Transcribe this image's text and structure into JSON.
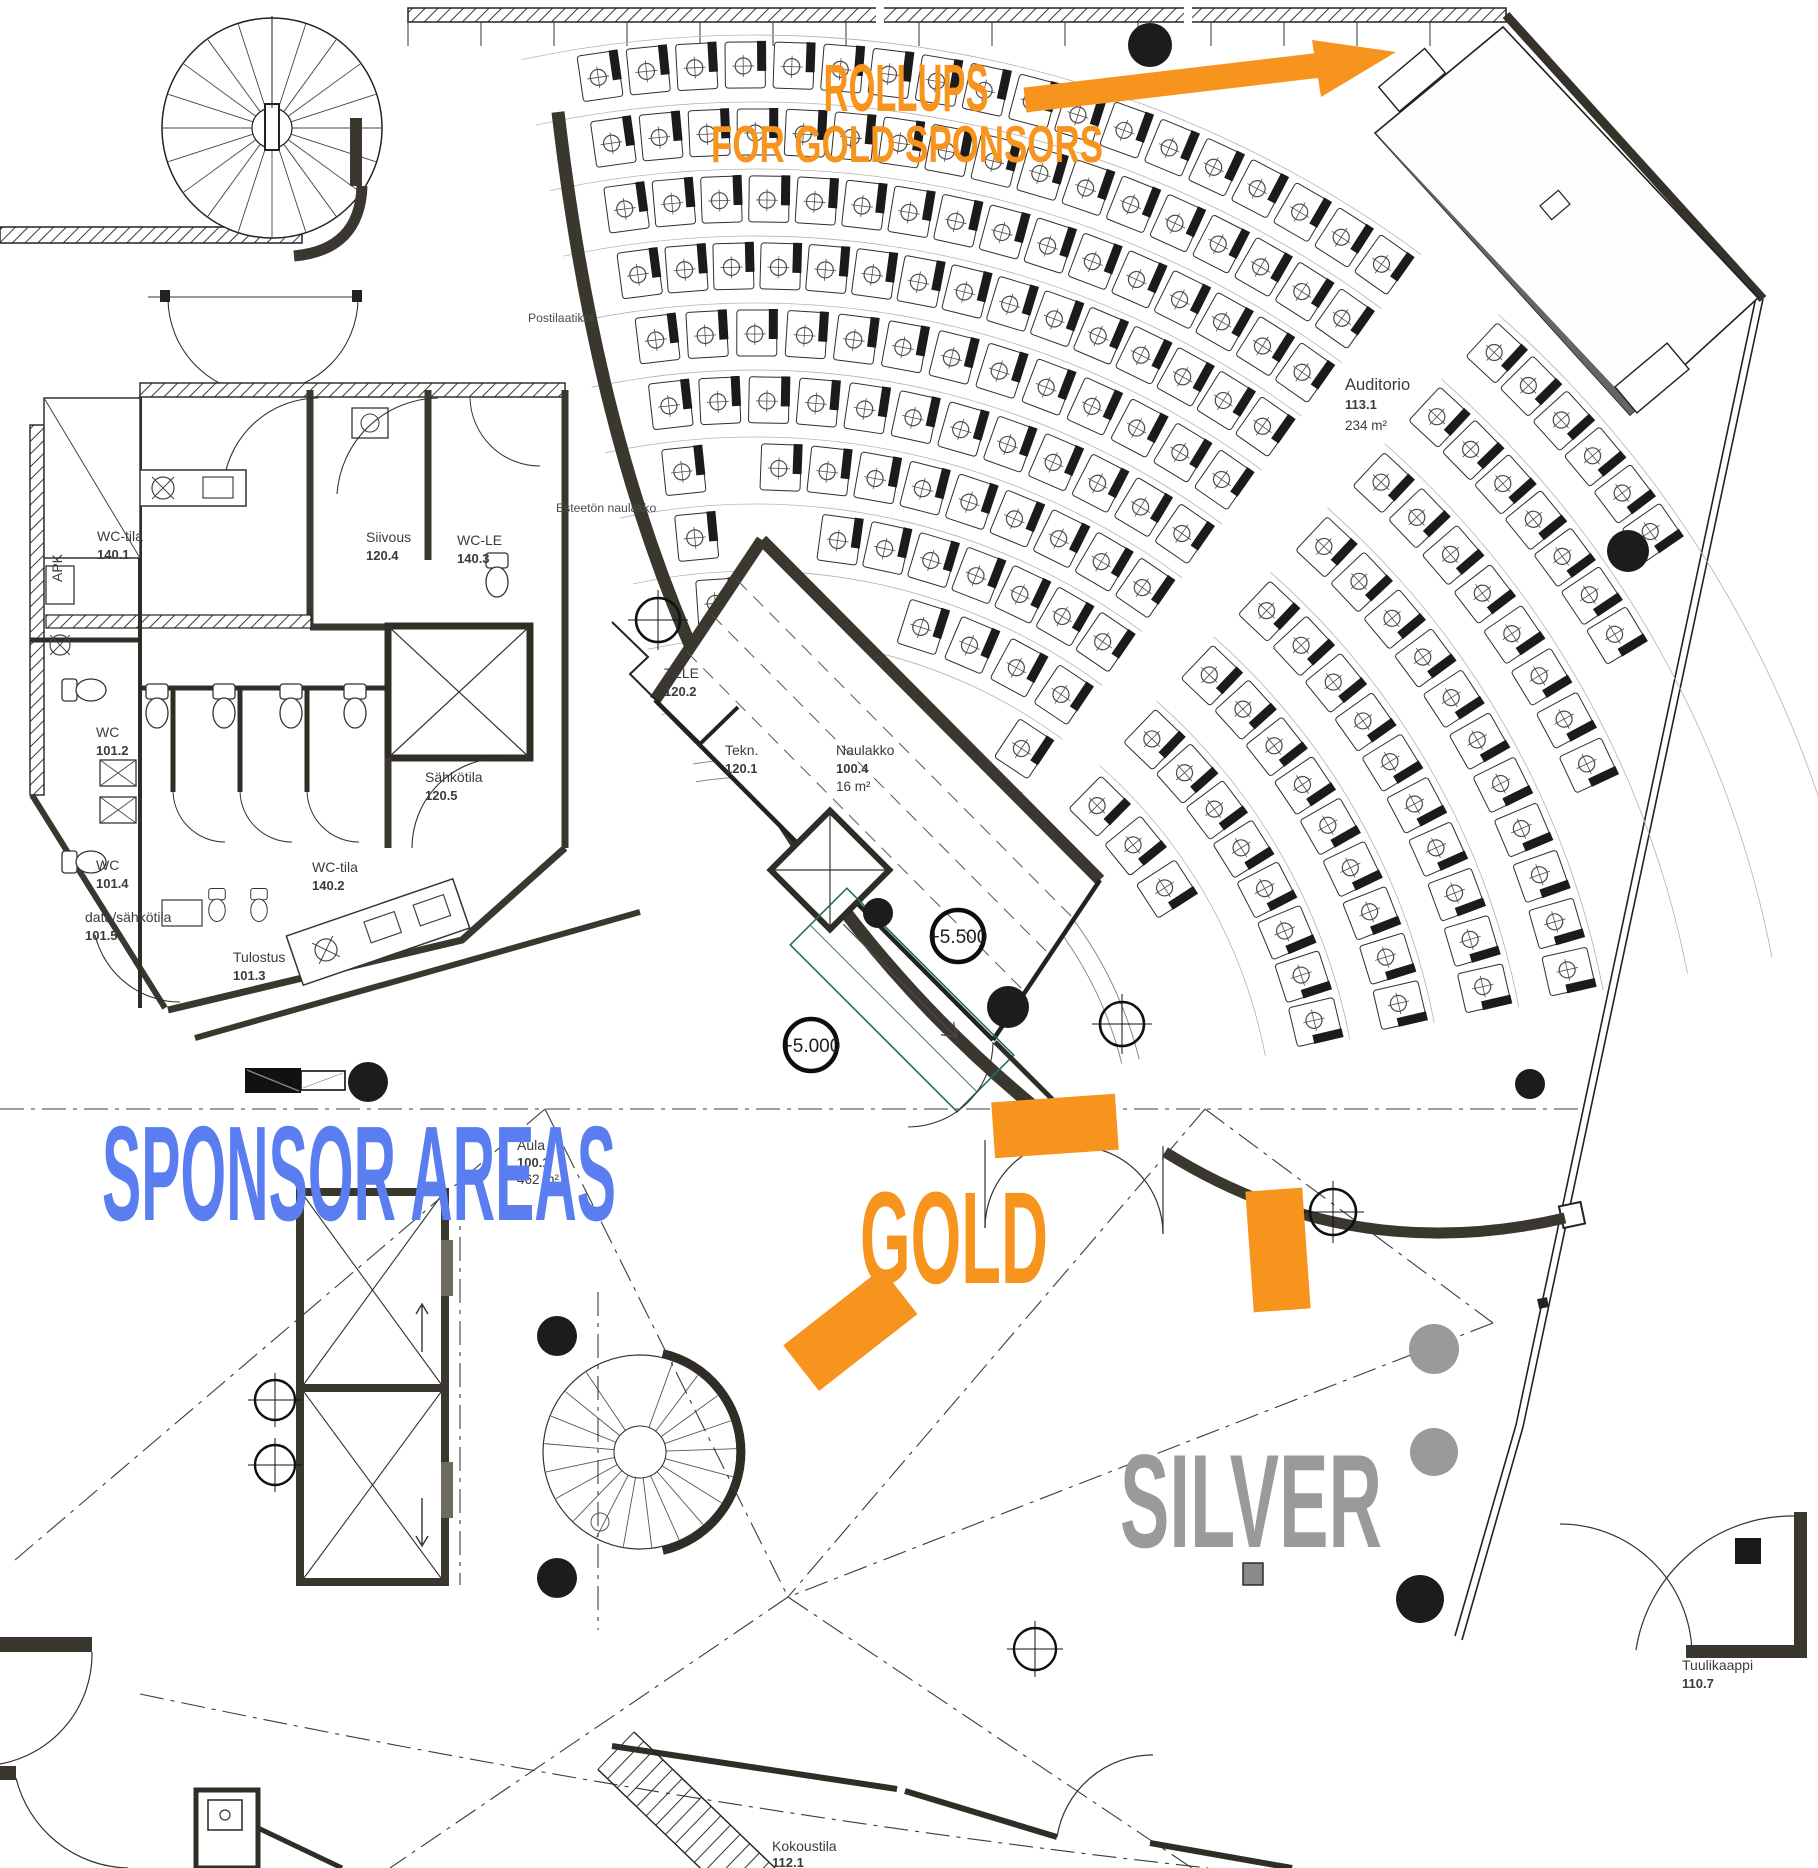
{
  "annotations": {
    "rollups_line1": "ROLLUPS",
    "rollups_line2": "FOR GOLD SPONSORS",
    "sponsor_areas": "SPONSOR AREAS",
    "gold": "GOLD",
    "silver": "SILVER"
  },
  "colors": {
    "orange": "#F7941E",
    "blue": "#5A7DF0",
    "gray": "#9A9A9A"
  },
  "rooms": {
    "wc_tila_1": {
      "name": "WC-tila",
      "number": "140.1"
    },
    "siivous": {
      "name": "Siivous",
      "number": "120.4"
    },
    "wc_le": {
      "name": "WC-LE",
      "number": "140.3"
    },
    "apk": {
      "name": "APK"
    },
    "wc_1": {
      "name": "WC",
      "number": "101.2"
    },
    "sahkotila": {
      "name": "Sähkötila",
      "number": "120.5"
    },
    "wc_2": {
      "name": "WC",
      "number": "101.4"
    },
    "data_sahkotila": {
      "name": "data/sähkötila",
      "number": "101.5"
    },
    "tulostus": {
      "name": "Tulostus",
      "number": "101.3"
    },
    "wc_tila_2": {
      "name": "WC-tila",
      "number": "140.2"
    },
    "tele": {
      "name": "TELE",
      "number": "120.2"
    },
    "tekn": {
      "name": "Tekn.",
      "number": "120.1"
    },
    "naulakko": {
      "name": "Naulakko",
      "number": "100.4",
      "area": "16 m²"
    },
    "auditorio": {
      "name": "Auditorio",
      "number": "113.1",
      "area": "234 m²"
    },
    "aula": {
      "name": "Aula",
      "number": "100.1",
      "area": "462 m²"
    },
    "tuulikaappi": {
      "name": "Tuulikaappi",
      "number": "110.7"
    },
    "kokoustila": {
      "name": "Kokoustila",
      "number": "112.1"
    }
  },
  "labels": {
    "postilaatikot": "Postilaatikot",
    "esteeton_naulakko": "Esteetön naulakko"
  },
  "elevation_markers": {
    "upper": "+5.500",
    "lower": "+5.000"
  },
  "floor_plan": {
    "auditorium_seating": {
      "center": [
        755,
        1155
      ],
      "seat_pitch": 47,
      "sections": [
        {
          "start_deg": -102,
          "end_deg": -53.5,
          "row_radii": [
            420,
            487,
            554,
            621,
            688,
            755,
            822,
            889,
            956,
            1023,
            1090
          ]
        },
        {
          "start_deg": -48.5,
          "end_deg": -11,
          "row_radii": [
            490,
            576,
            662,
            748,
            834,
            920,
            1006,
            1092
          ]
        }
      ]
    }
  }
}
